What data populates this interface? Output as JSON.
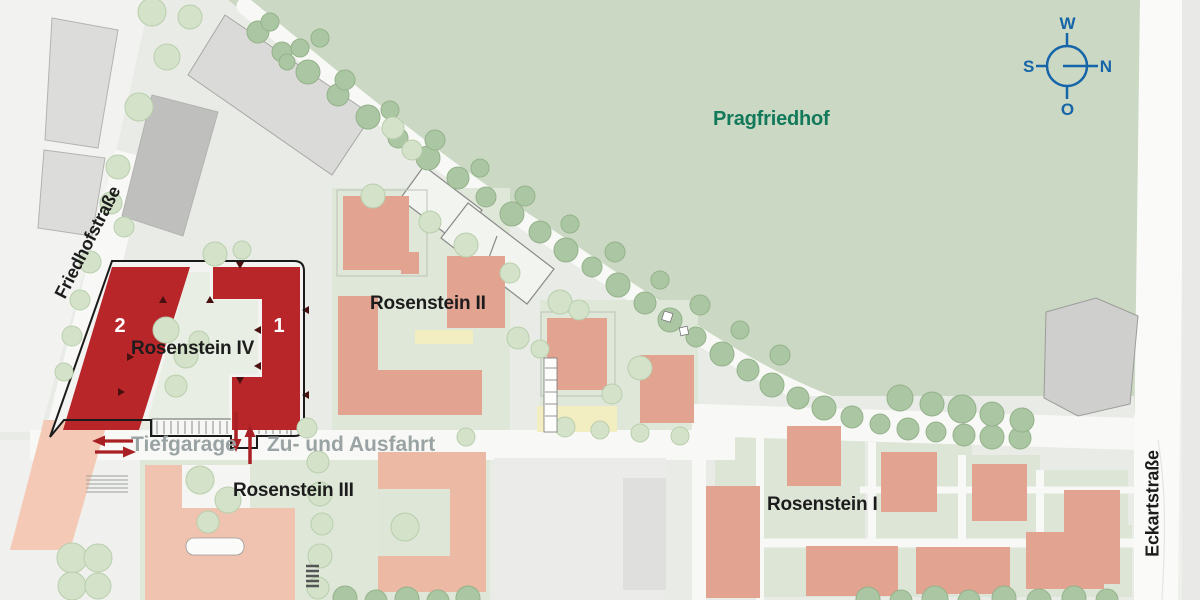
{
  "map": {
    "region_labels": {
      "cemetery": "Pragfriedhof",
      "rosenstein_iv": "Rosenstein IV",
      "rosenstein_iii": "Rosenstein III",
      "rosenstein_ii": "Rosenstein II",
      "rosenstein_i": "Rosenstein I"
    },
    "building_numbers": {
      "left": "2",
      "right": "1"
    },
    "garage_note": {
      "prefix": "Tiefgarage",
      "suffix": "Zu- und Ausfahrt"
    },
    "streets": {
      "west": "Friedhofstraße",
      "east": "Eckartstraße"
    },
    "compass": {
      "top": "W",
      "left": "S",
      "right": "N",
      "bottom": "O"
    },
    "colors": {
      "cemetery_green": "#cbd8c3",
      "tree_dark": "#abc6a2",
      "tree_light": "#d3e2c9",
      "yard_green": "#dfe7d9",
      "building_salmon": "#e3a391",
      "building_salmon_light": "#efc3b0",
      "building_red": "#b8262a",
      "building_gray": "#d6d6d4",
      "road_white": "#f8f9f6",
      "label_green": "#13795b",
      "compass_blue": "#1565a8",
      "garage_text_gray": "#9aa3a3",
      "arrow_red": "#a81f24"
    }
  }
}
